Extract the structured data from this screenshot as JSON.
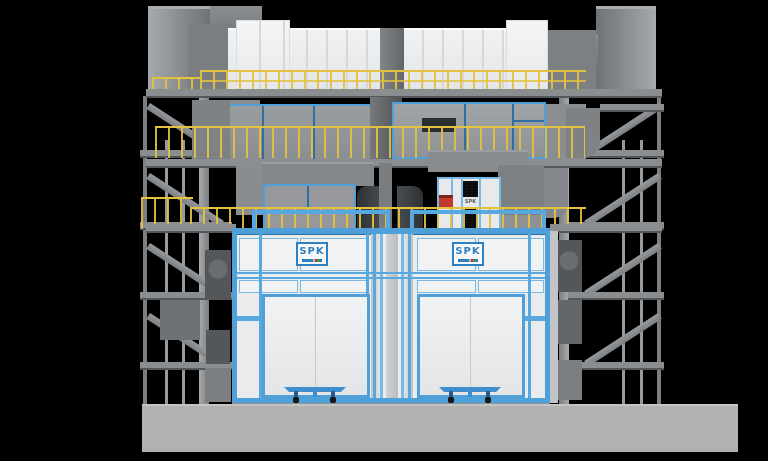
{
  "scene": {
    "type": "3d-render",
    "subject": "twin-chamber industrial spray booth plant with multi-level duct platforms and side stair towers"
  },
  "labels": {
    "booth_logo_left": "SPK",
    "booth_logo_right": "SPK",
    "cabinet_logo": "SPK"
  },
  "colors": {
    "bg": "#000000",
    "base": "#b3b1af",
    "base_light": "#c6c4c2",
    "blue": "#4fa0d8",
    "blue_light": "#79b9e6",
    "blue_dark": "#2e6fa0",
    "logo_blue": "#2f7fc1",
    "yellow": "#e3c23f",
    "wall": "#e9ebed",
    "wall_shade": "#d8dbde",
    "panel": "#f0f2f3",
    "ahu_white": "#f1f2f3",
    "seam": "#d5d7da",
    "duct": "#8b8e91",
    "duct_dark": "#6f7275",
    "duct_darker": "#54575a",
    "duct_light": "#a7aaad",
    "steel": "#979a9d",
    "steel_dark": "#7c7f82",
    "fan": "#35383b",
    "red": "#c0392b"
  }
}
